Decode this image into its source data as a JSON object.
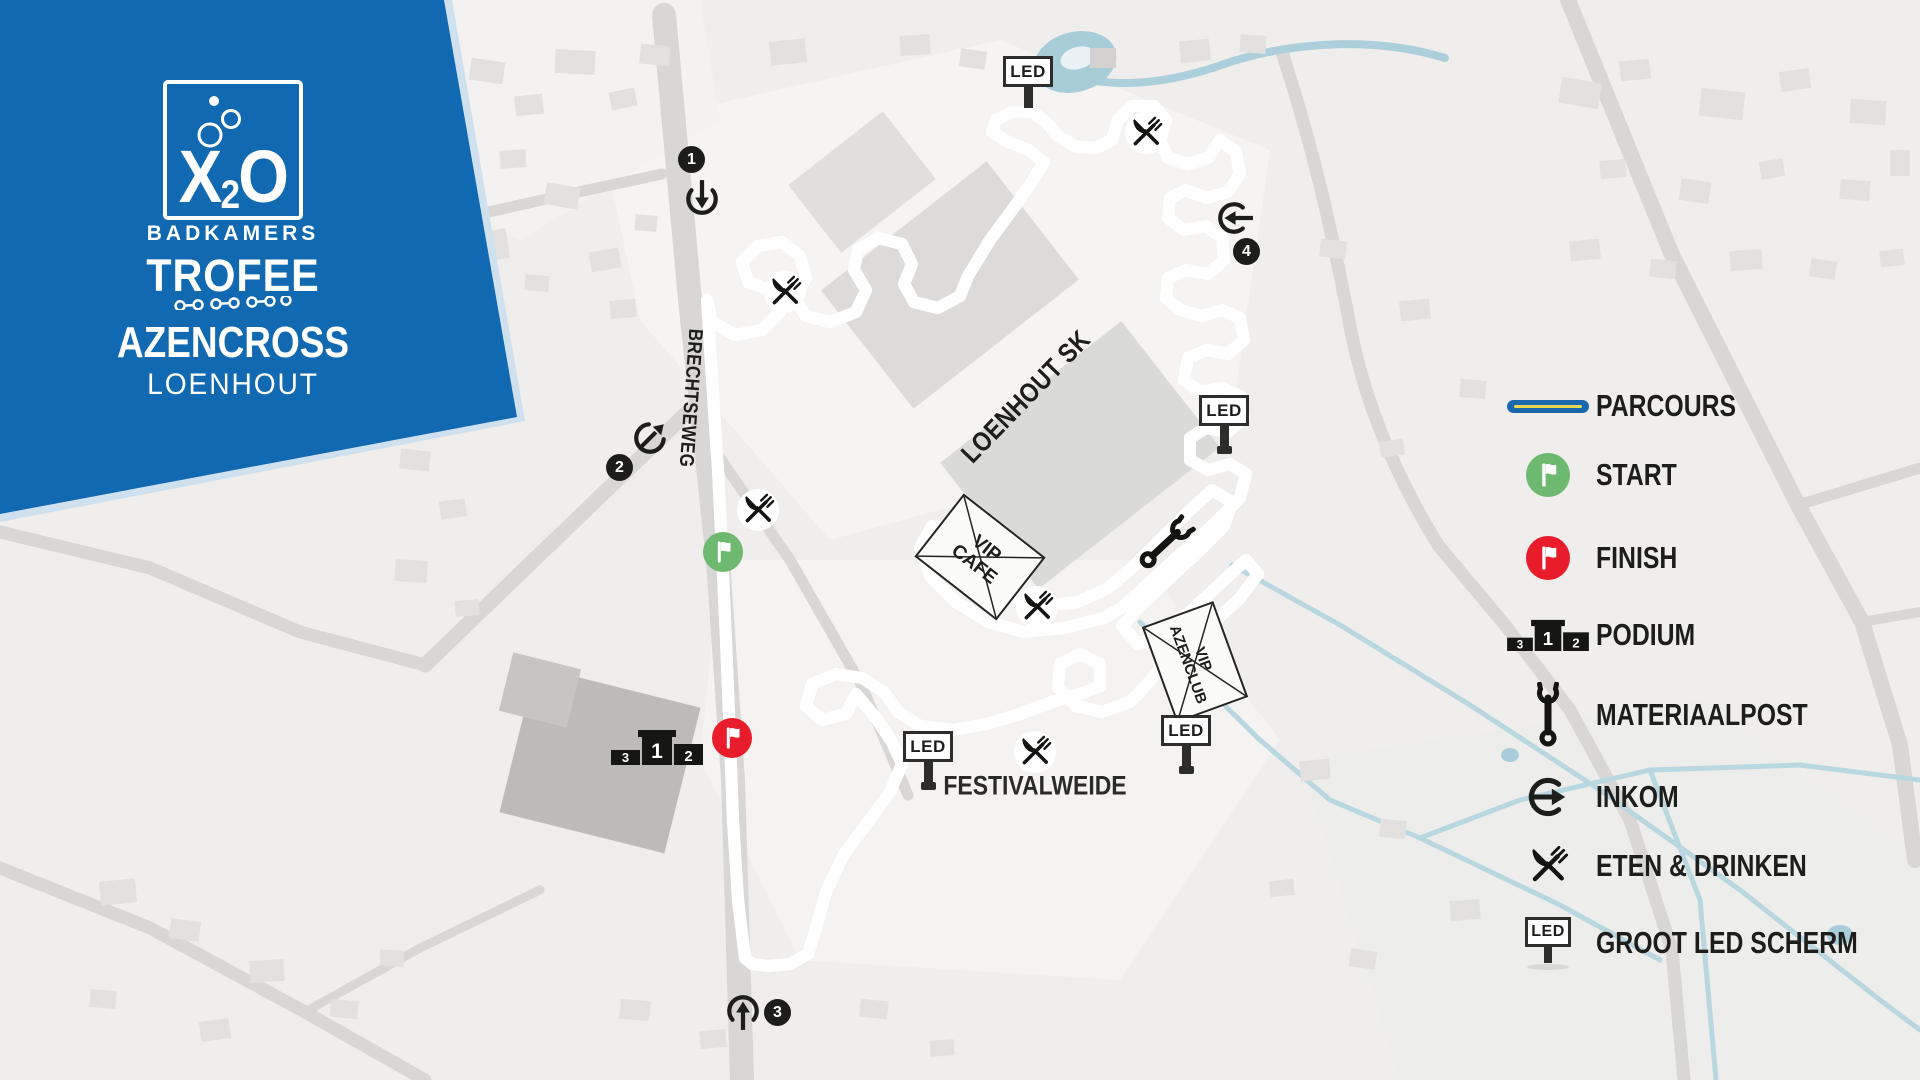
{
  "branding": {
    "banner_color": "#1169b1",
    "logo_x": "X",
    "logo_sub": "2",
    "logo_o": "O",
    "logo_badkamers": "BADKAMERS",
    "logo_trofee": "TROFEE",
    "event_name": "AZENCROSS",
    "event_location": "LOENHOUT"
  },
  "map": {
    "street_label": "BRECHTSEWEG",
    "site_label": "LOENHOUT SK",
    "field_label": "FESTIVALWEIDE",
    "led_sign_label": "LED",
    "tents": [
      {
        "line1": "VIP",
        "line2": "CAFE"
      },
      {
        "line1": "VIP",
        "line2": "AZENCLUB"
      }
    ],
    "route_markers": [
      {
        "number": "1",
        "direction": "down"
      },
      {
        "number": "2",
        "direction": "up-right"
      },
      {
        "number": "3",
        "direction": "up"
      },
      {
        "number": "4",
        "direction": "left"
      }
    ],
    "podium_numbers": {
      "first": "1",
      "second": "2",
      "third": "3"
    },
    "colors": {
      "parcours_blue": "#1b67ae",
      "parcours_yellow": "#e6d84f",
      "start_green": "#6cb96f",
      "finish_red": "#e81c2a",
      "marker_black": "#1d1d1b",
      "water_blue": "#b9d7e1"
    }
  },
  "legend": {
    "items": [
      {
        "id": "parcours",
        "label": "PARCOURS"
      },
      {
        "id": "start",
        "label": "START"
      },
      {
        "id": "finish",
        "label": "FINISH"
      },
      {
        "id": "podium",
        "label": "PODIUM"
      },
      {
        "id": "materiaalpost",
        "label": "MATERIAALPOST"
      },
      {
        "id": "inkom",
        "label": "INKOM"
      },
      {
        "id": "eten-drinken",
        "label": "ETEN & DRINKEN"
      },
      {
        "id": "groot-led-scherm",
        "label": "GROOT LED SCHERM"
      }
    ]
  }
}
